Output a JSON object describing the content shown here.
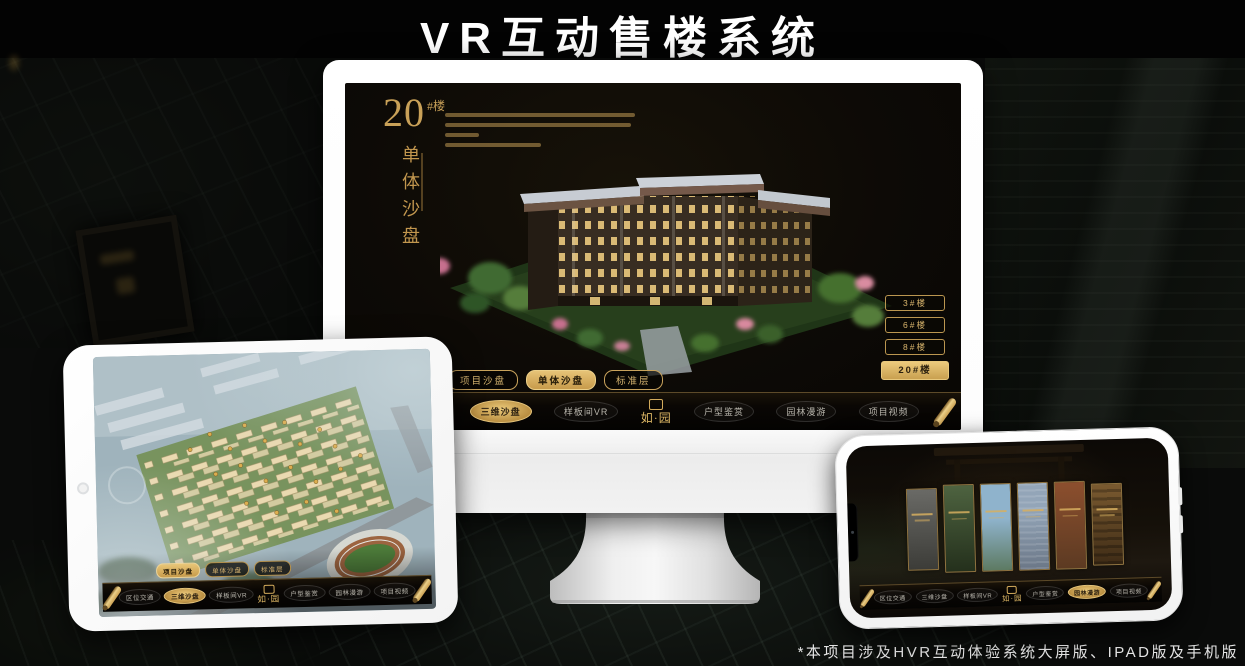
{
  "page": {
    "title": "VR互动售楼系统",
    "footnote": "*本项目涉及HVR互动体验系统大屏版、IPAD版及手机版"
  },
  "colors": {
    "gold": "#c9a158",
    "gold_bright": "#ecca7c",
    "screen_background": "#0d0a06",
    "monitor_shell": "#ffffff"
  },
  "brand": {
    "logo_text": "如·园"
  },
  "nav": {
    "items": [
      "区位交通",
      "三维沙盘",
      "样板间VR",
      "户型鉴赏",
      "园林漫游",
      "项目视频"
    ],
    "monitor_active": "三维沙盘",
    "tablet_active": "三维沙盘",
    "phone_active": "园林漫游"
  },
  "monitor_screen": {
    "block_number": "20",
    "block_unit": "#楼",
    "vertical_title": "单体沙盘",
    "floor_buttons": [
      "3#楼",
      "6#楼",
      "8#楼",
      "20#楼"
    ],
    "selected_floor": "20#楼",
    "subtabs": [
      "项目沙盘",
      "单体沙盘",
      "标准层"
    ],
    "selected_subtab": "单体沙盘"
  },
  "tablet_screen": {
    "subtabs": [
      "项目沙盘",
      "单体沙盘",
      "标准层"
    ],
    "selected_subtab": "项目沙盘"
  }
}
